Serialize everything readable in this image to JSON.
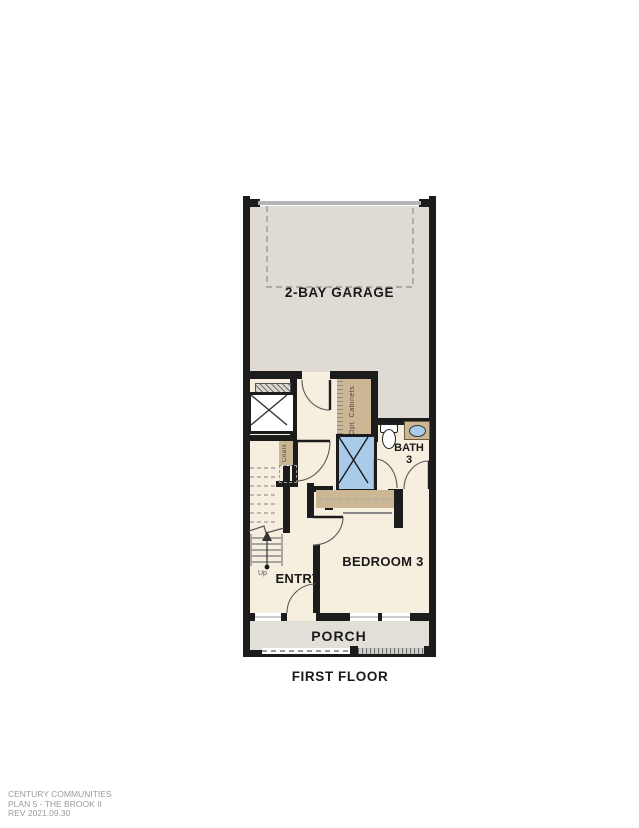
{
  "labels": {
    "garage": "2-BAY GARAGE",
    "bath_line1": "BATH",
    "bath_line2": "3",
    "bedroom": "BEDROOM 3",
    "entry": "ENTRY",
    "porch": "PORCH",
    "first_floor": "FIRST FLOOR",
    "up": "Up",
    "opt_cabinets": "Opt. Cabinets",
    "coats": "Coats"
  },
  "footer": {
    "line1": "CENTURY COMMUNITIES",
    "line2": "PLAN 5 - THE BROOK II",
    "line3": "REV 2021.09.30"
  },
  "colors": {
    "wall": "#1c1c1c",
    "garage_floor": "#dfdbd4",
    "house_floor": "#f6efdf",
    "porch_floor": "#e2dfd8",
    "cabinet_tan": "#ccb795",
    "fixture_blue": "#a9cbe9",
    "dashed_gray": "#9a9a9a",
    "footer_gray": "#9b9b9b"
  }
}
